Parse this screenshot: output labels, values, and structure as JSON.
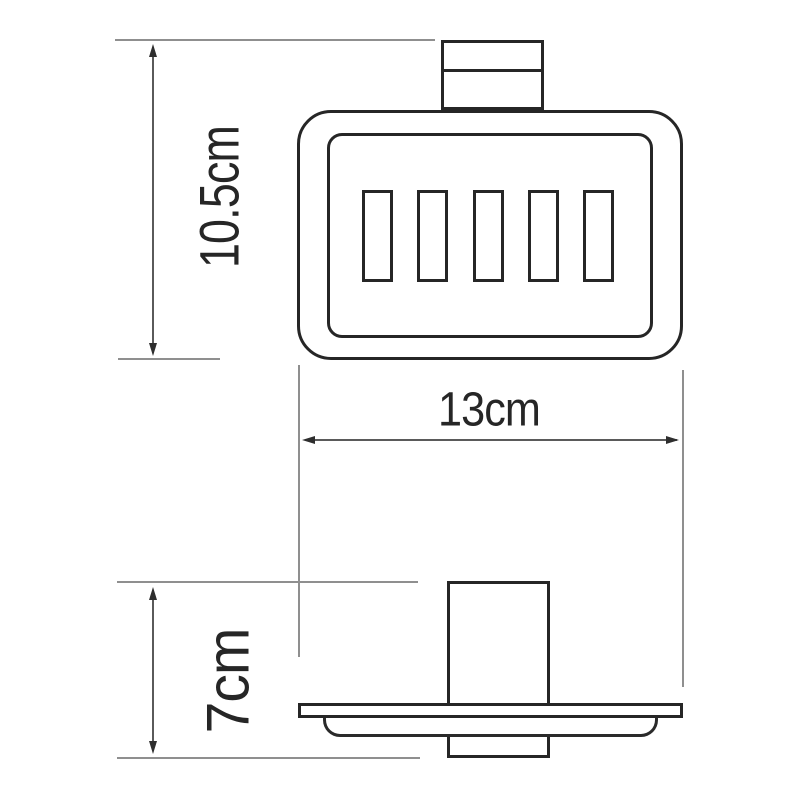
{
  "drawing": {
    "type": "technical dimension drawing",
    "subject": "wall-mounted soap dish holder, front and side views",
    "background": "#ffffff",
    "colors": {
      "outline": "#262626",
      "dimension_line": "#5a5a5a",
      "extension_line": "#8f8f8f",
      "label_text": "#262626"
    },
    "front_view": {
      "slot_count": 5
    },
    "dimensions": {
      "height": {
        "label": "10.5cm"
      },
      "width": {
        "label": "13cm"
      },
      "depth": {
        "label": "7cm"
      }
    }
  }
}
